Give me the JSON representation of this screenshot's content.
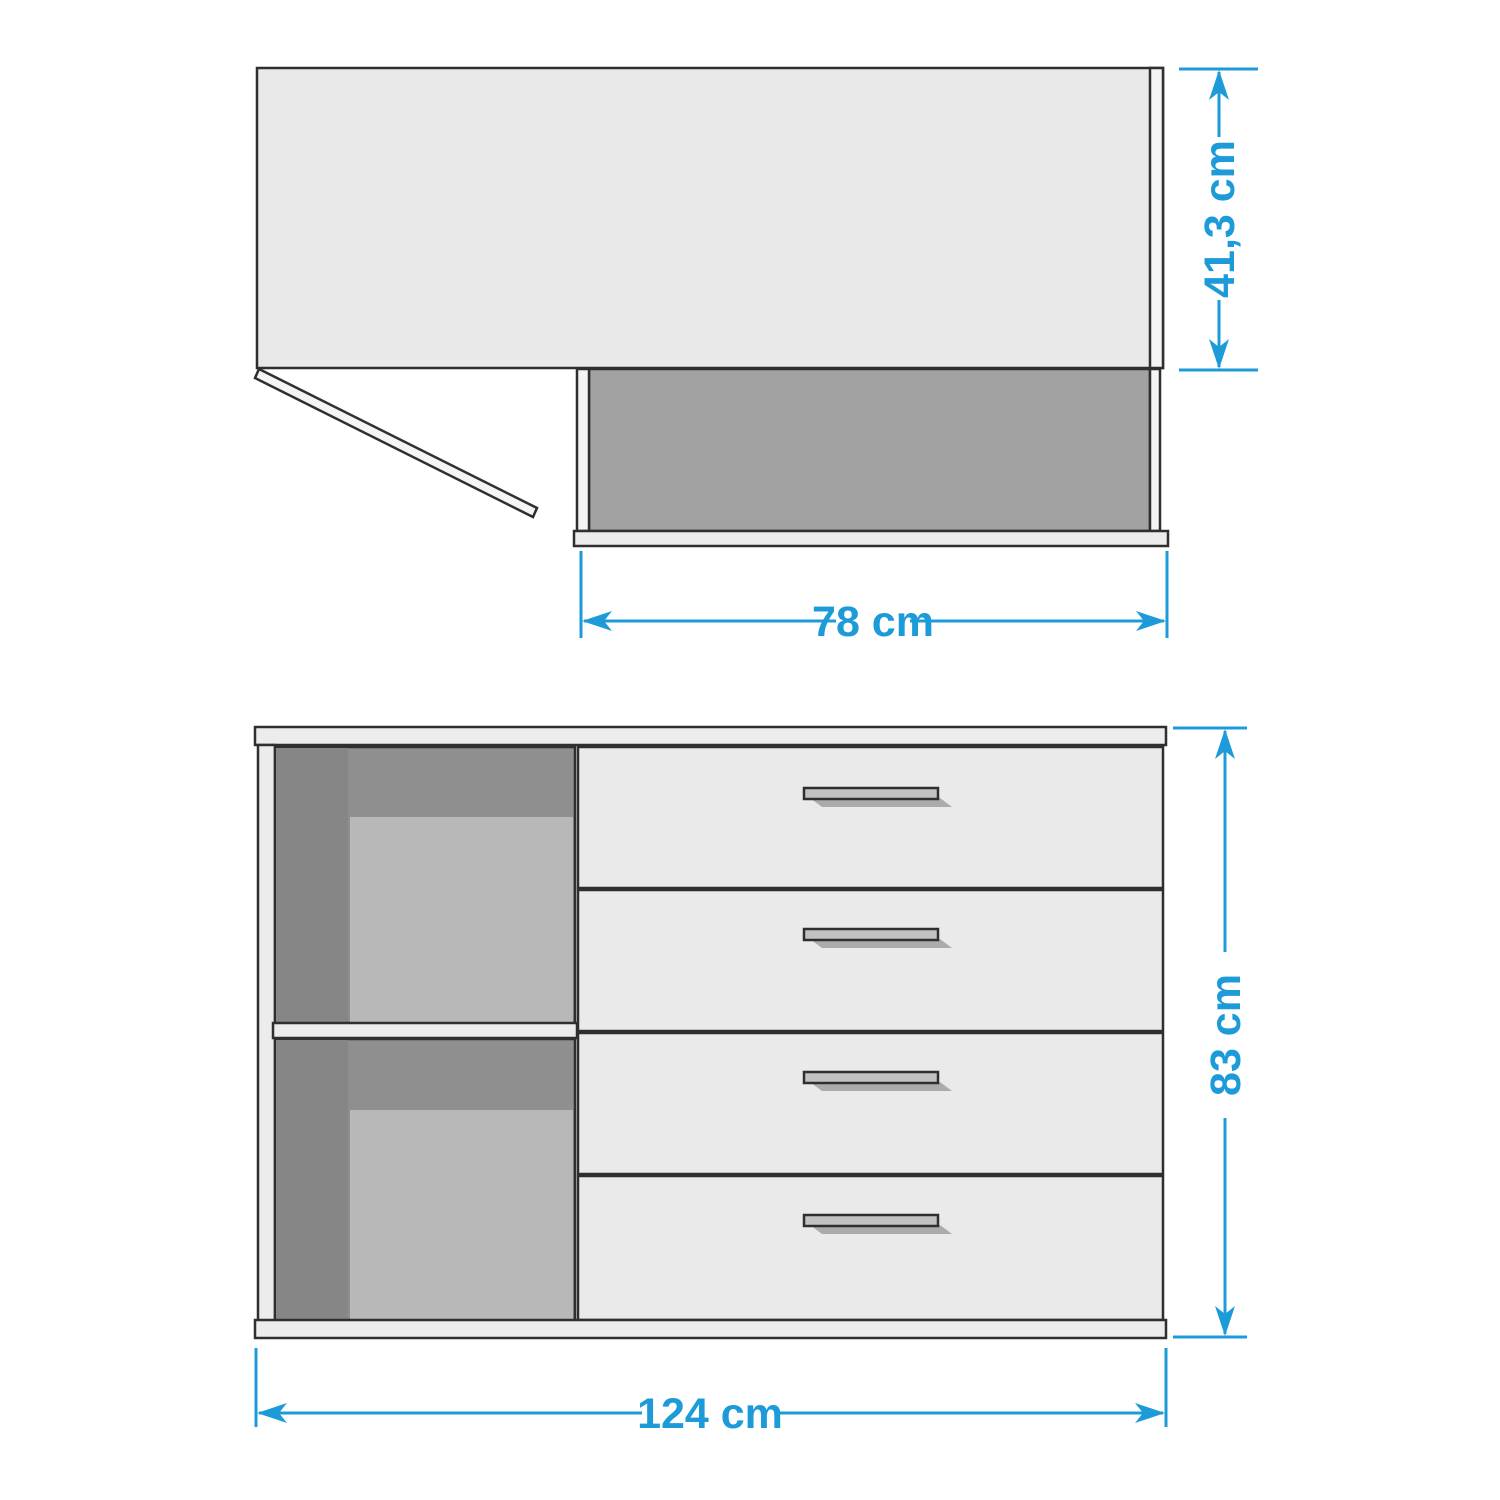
{
  "top_view": {
    "depth_label": "41,3 cm",
    "width_label": "78 cm"
  },
  "front_view": {
    "height_label": "83 cm",
    "width_label": "124 cm"
  },
  "colors": {
    "background": "#ffffff",
    "outline": "#2f2f2f",
    "dimension_blue": "#1d9bd8",
    "desk_top": "#e9e9e9",
    "panel_white": "#f4f4f4",
    "back_panel_dark": "#a2a2a2",
    "strip_light": "#ececec",
    "compartment_dark": "#8f8f8f",
    "compartment_side_dark": "#868686",
    "compartment_back_light": "#b8b8b8",
    "drawer_face": "#eaeaea",
    "handle_fill": "#c2c2c2",
    "handle_shadow": "#ababab"
  }
}
